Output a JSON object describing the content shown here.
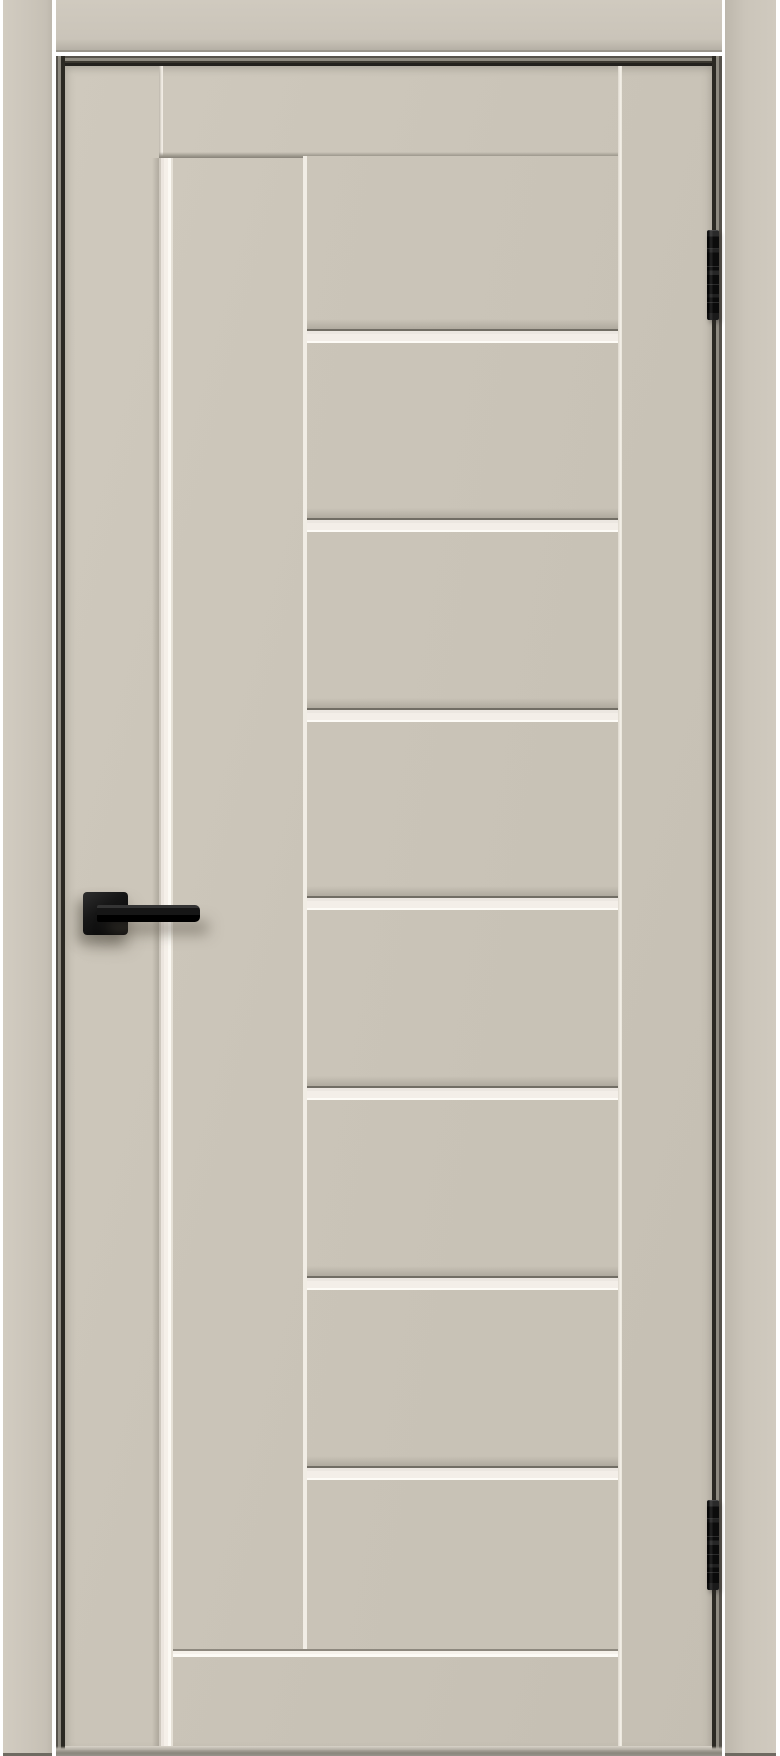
{
  "image": {
    "width": 780,
    "height": 1756,
    "description": "Beige interior door in frame with black square-rose lever handle, two black hinges on the right edge, one full-height vertical frosted glass insert and seven horizontal frosted glass inserts"
  },
  "palette": {
    "background": "#ffffff",
    "casing_beige": "#cbc5ba",
    "leaf_beige": "#cac4b8",
    "panel_beige": "#c8c2b6",
    "glass_white": "#f3eee8",
    "glass_bright": "#fdfbf6",
    "frame_dark": "#2b2923",
    "hardware_black": "#141414",
    "shadow_gray": "#8a867c"
  },
  "door": {
    "leaf": {
      "x": 65,
      "y": 66,
      "w": 647,
      "h": 1684
    },
    "vertical_glass": {
      "x": 159,
      "y": 158,
      "w": 14,
      "h": 1592
    },
    "glazed_column": {
      "x": 303,
      "y": 156,
      "w": 315,
      "h": 1494,
      "panel_count": 8
    },
    "horizontal_strips": {
      "tops": [
        329,
        518,
        708,
        896,
        1086,
        1276,
        1466
      ],
      "height": 14,
      "x": 307,
      "w": 311
    },
    "handle": {
      "rose": {
        "x": 83,
        "y": 892,
        "w": 45,
        "h": 43
      },
      "lever": {
        "x": 97,
        "y": 905,
        "w": 103,
        "h": 17
      }
    },
    "hinges": [
      {
        "x": 707,
        "y": 230,
        "w": 12,
        "h": 90
      },
      {
        "x": 707,
        "y": 1500,
        "w": 12,
        "h": 90
      }
    ]
  },
  "frame": {
    "casing_left": {
      "x": 3,
      "w": 49
    },
    "casing_right": {
      "x": 725,
      "w": 51
    },
    "casing_top": {
      "x": 56,
      "w": 666,
      "h": 52
    }
  }
}
